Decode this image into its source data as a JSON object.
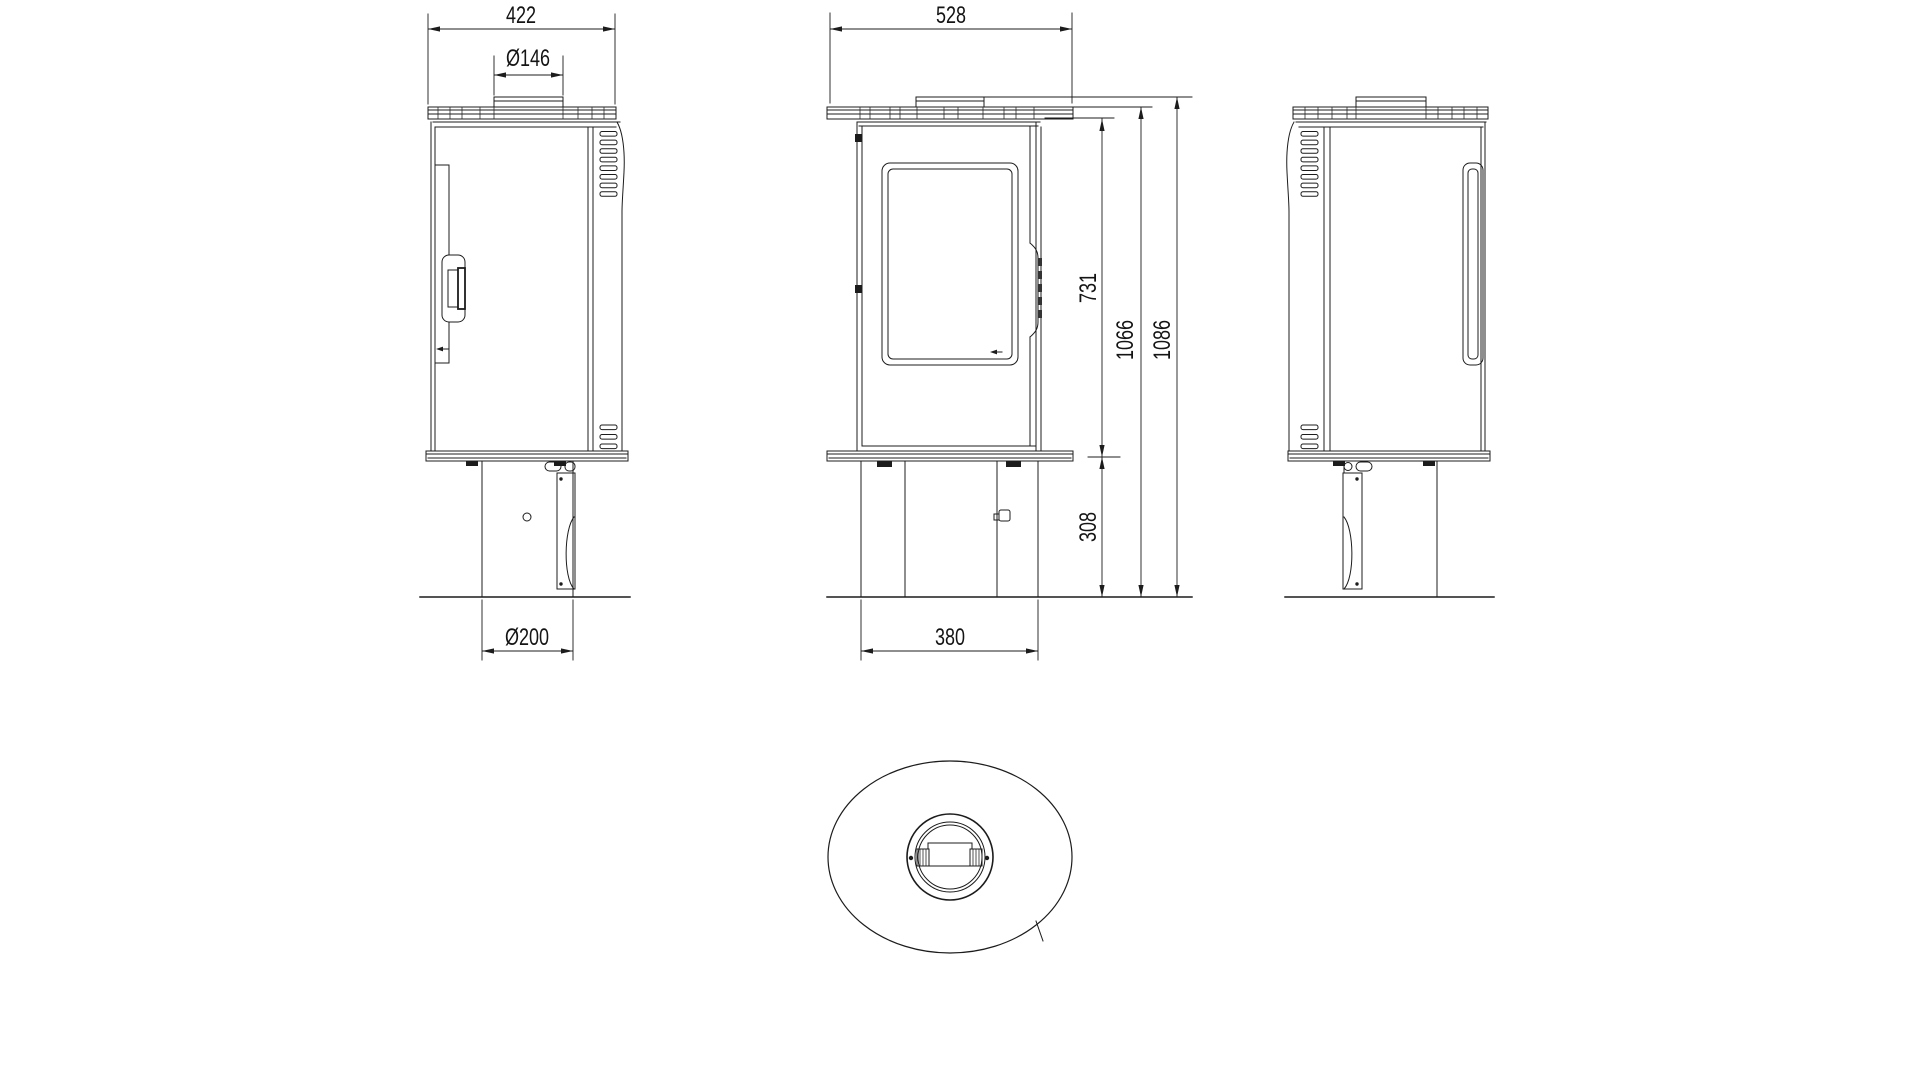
{
  "page": {
    "background": "#ffffff"
  },
  "drawing": {
    "type": "stove-technical-drawing",
    "stroke_color": "#1c1c1c",
    "dimensions": {
      "side_width": "422",
      "flue_diameter": "Ø146",
      "front_width": "528",
      "door_height": "731",
      "body_height": "1066",
      "total_height": "1086",
      "pedestal_height": "308",
      "base_diameter": "Ø200",
      "pedestal_width": "380"
    }
  }
}
